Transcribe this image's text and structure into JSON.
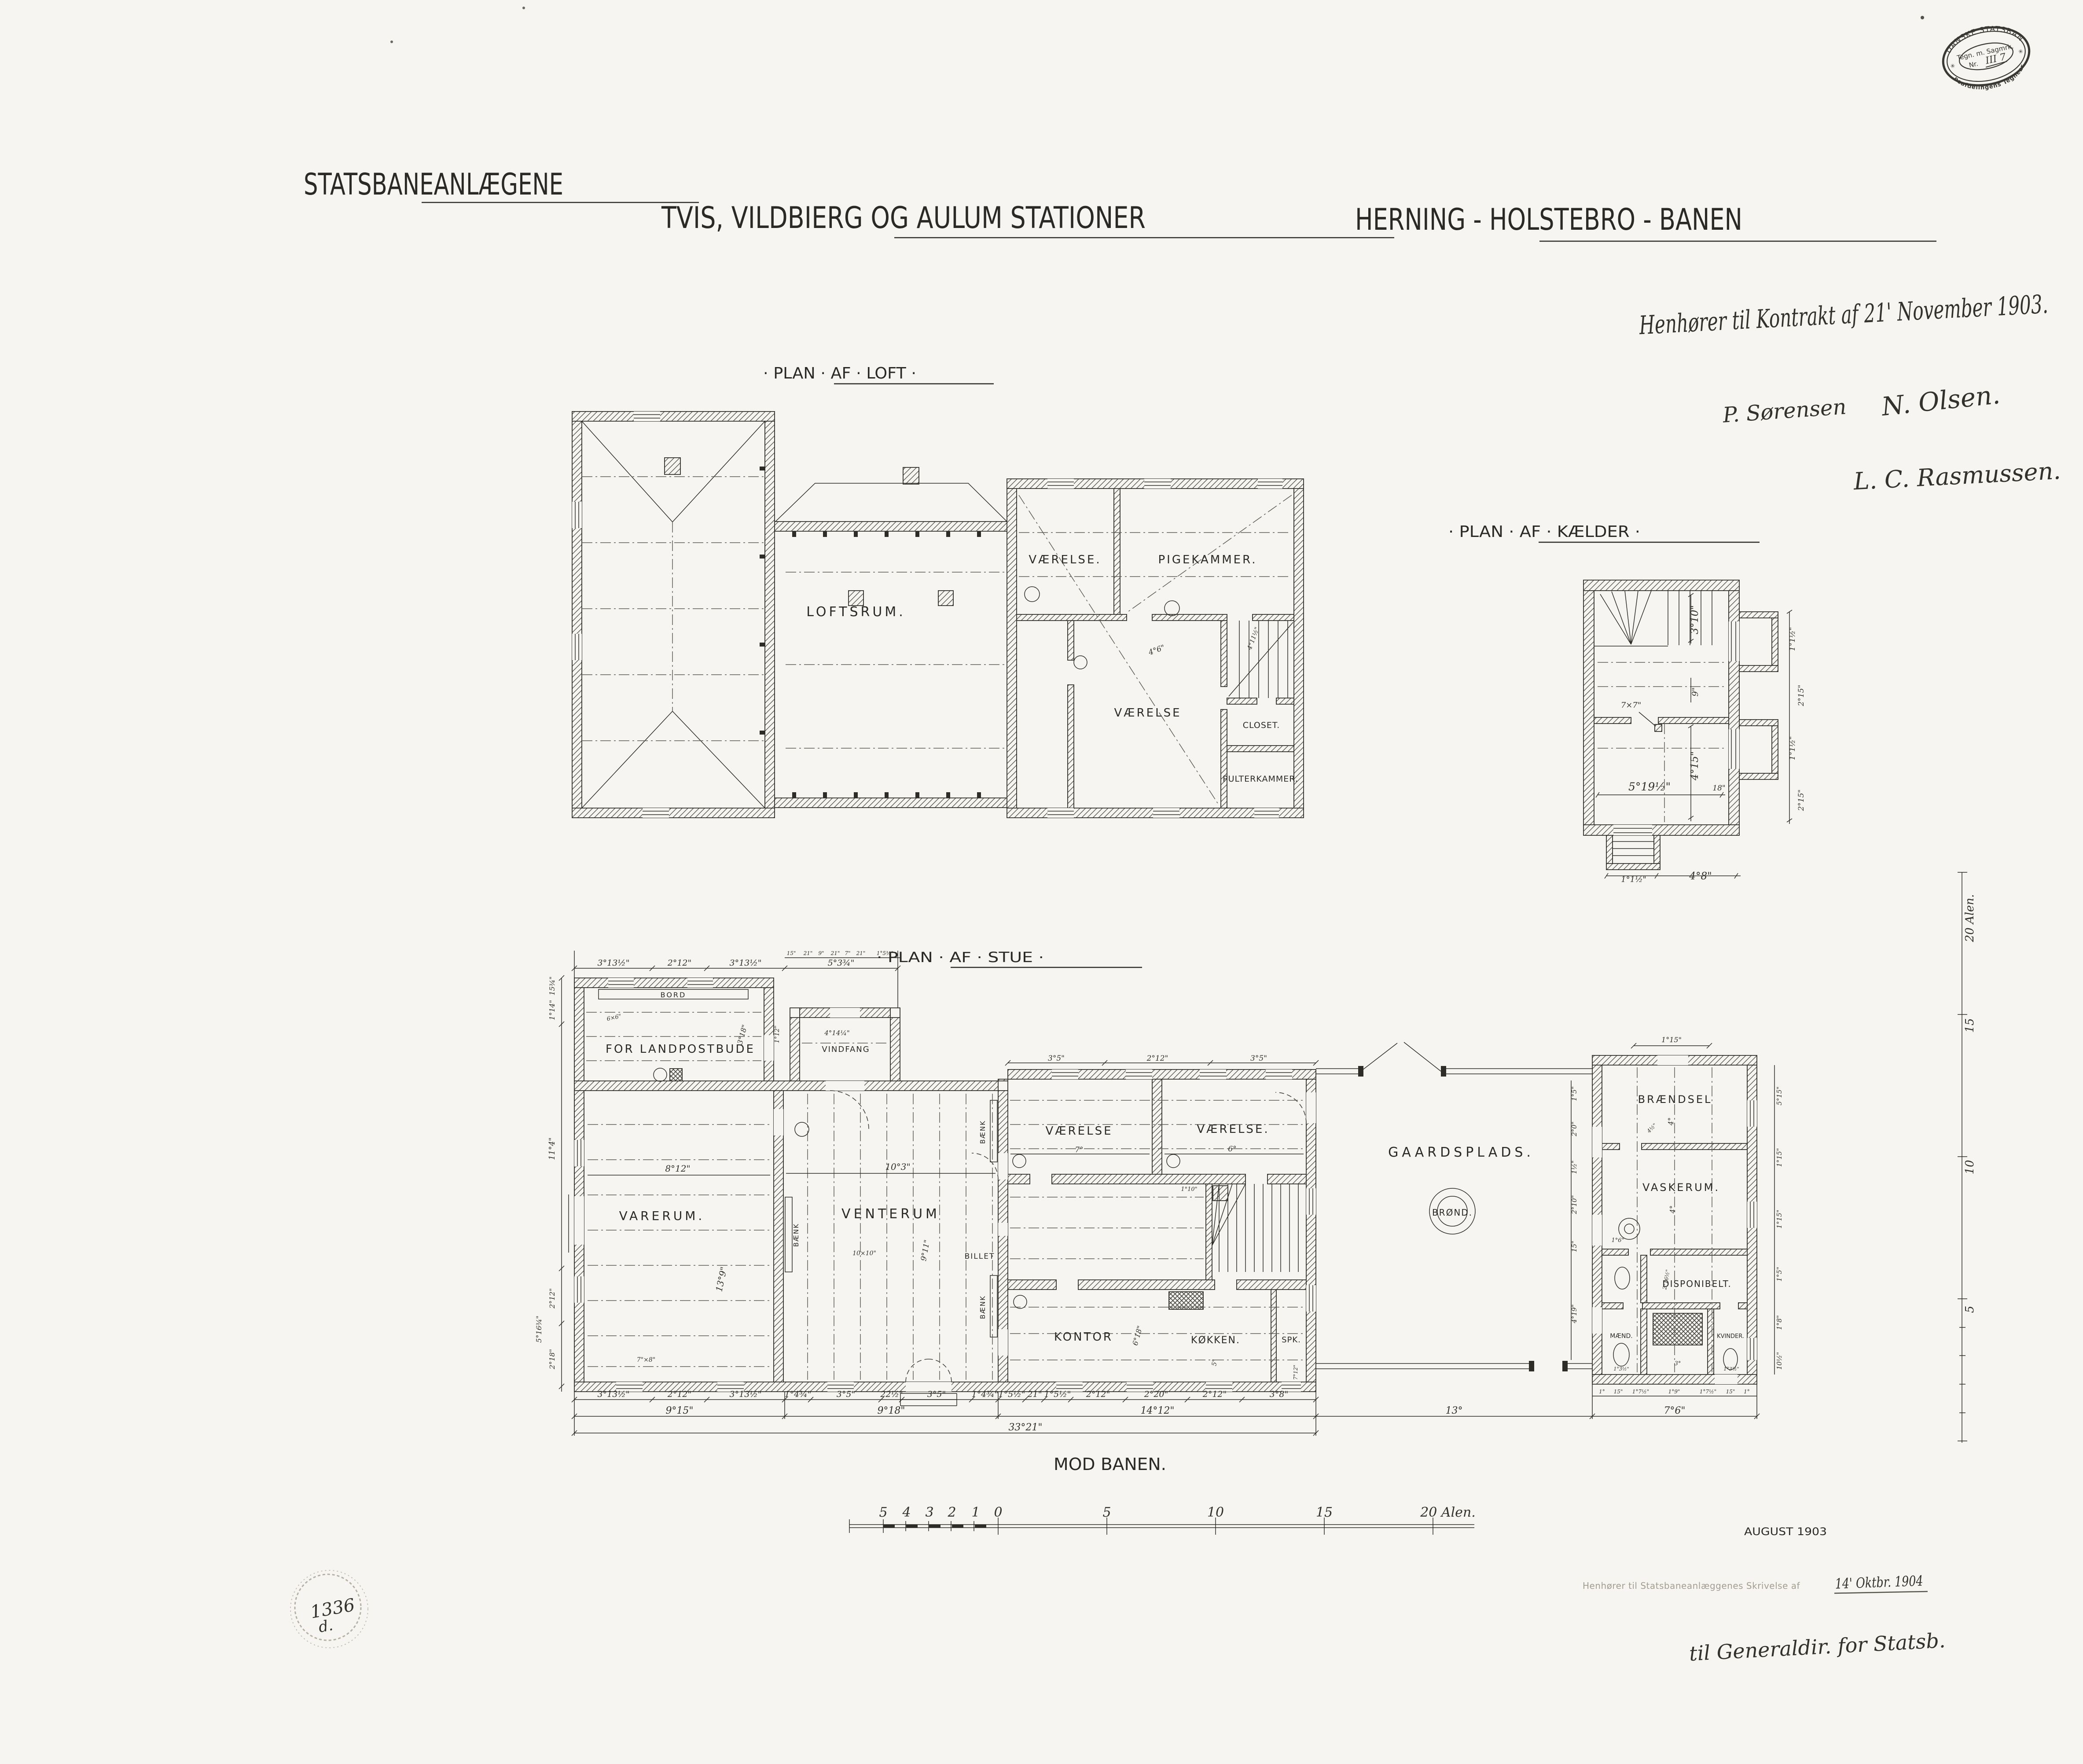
{
  "colors": {
    "paper": "#f6f5f1",
    "ink": "#2e2c27",
    "faint_ink": "#a39d8f",
    "stamp_ink": "#3a3832"
  },
  "header": {
    "program": "STATSBANEANLÆGENE",
    "title": "TVIS, VILDBIERG OG AULUM STATIONER",
    "railway": "HERNING - HOLSTEBRO - BANEN",
    "note": "Henhører til Kontrakt af 21' November 1903.",
    "signature_1": "P. Sørensen",
    "signature_2": "N. Olsen.",
    "signature_3": "L. C. Rasmussen."
  },
  "archive_stamp": {
    "arc_top": "DE DANSKE STATSBANER",
    "row": "Tegn. m. Sagmrk.",
    "nr_label": "Nr.",
    "nr_value": "III 7",
    "arc_bottom": "Baneafdelingens Tegnearkiv",
    "star": "✳"
  },
  "loft": {
    "title": "· PLAN · AF · LOFT ·",
    "rooms": {
      "loftsrum": "LOFTSRUM.",
      "vaerelse_nv": "VÆRELSE.",
      "pigekammer": "PIGEKAMMER.",
      "vaerelse_mid": "VÆRELSE",
      "closet": "CLOSET.",
      "pulterkammer": "PULTERKAMMER."
    },
    "dims": {
      "d1": "4°6\"",
      "d2": "4°11½\""
    }
  },
  "kaelder": {
    "title": "· PLAN · AF · KÆLDER ·",
    "dims": {
      "stair_h": "3°10\"",
      "gap9": "9\"",
      "post": "7×7\"",
      "room_h": "4°15\"",
      "room_w": "5°19½\"",
      "w18": "18\"",
      "right_1": "1°1½\"",
      "right_2": "2°15\"",
      "right_3": "1°1½\"",
      "right_4": "2°15\"",
      "bottom_1": "1°1½\"",
      "bottom_2": "4°8\""
    }
  },
  "stue": {
    "title": "· PLAN · AF · STUE ·",
    "rooms": {
      "landpost": "FOR LANDPOSTBUDE",
      "vindfang": "VINDFANG",
      "varerum": "VARERUM.",
      "venterum": "VENTERUM",
      "vaerelse_1": "VÆRELSE",
      "vaerelse_2": "VÆRELSE.",
      "kontor": "KONTOR",
      "koekken": "KØKKEN.",
      "spisekammer": "SPK.",
      "gaardsplads": "GAARDSPLADS.",
      "broend": "BRØND.",
      "braendsel": "BRÆNDSEL",
      "vaskerum": "VASKERUM.",
      "disponibelt": "DISPONIBELT.",
      "maend": "MÆND.",
      "kvinder": "KVINDER."
    },
    "furniture": {
      "bord": "BORD",
      "baenk": "BÆNK",
      "billet": "BILLET"
    },
    "dims": {
      "top_row": [
        "3°13½\"",
        "2°12\"",
        "3°13½\"",
        "5°3¾\""
      ],
      "top_small": [
        "15\"",
        "21\"",
        "9\"",
        "21\"",
        "7\"",
        "21\"",
        "1°5¾\""
      ],
      "wing_top": [
        "3°5\"",
        "2°12\"",
        "3°5\""
      ],
      "left_col": [
        "15¾\"",
        "1°14\"",
        "11°4\"",
        "2°12\"",
        "2°18\"",
        "5°16¾\""
      ],
      "row1": [
        "3°13½\"",
        "2°12\"",
        "3°13½\"",
        "1°4¾\"",
        "3°5\"",
        "22½\"",
        "3°5\"",
        "1°4¾\"",
        "1°5½\"",
        "21\"",
        "1°5½\"",
        "2°12\"",
        "2°20\"",
        "2°12\"",
        "3°8\""
      ],
      "row2": [
        "9°15\"",
        "9°18\"",
        "14°12\"",
        "13°",
        "7°6\""
      ],
      "row3": [
        "33°21\""
      ],
      "out_chain": [
        "1°",
        "15\"",
        "1°7½\"",
        "1°9\"",
        "1°7½\"",
        "15\"",
        "1°"
      ],
      "court_left": [
        "1°5\"",
        "2°0\"",
        "1½\"",
        "2°10\"",
        "15\"",
        "4°19\""
      ],
      "out_right": [
        "5°15\"",
        "1°15\"",
        "1°15\"",
        "1°5\"",
        "1°8\"",
        "10½\""
      ],
      "inner": {
        "varerum_w": "8°12\"",
        "varerum_h": "13°9\"",
        "varerum_note": "7\"×8\"",
        "venterum_w": "10°3\"",
        "venterum_note": "10×10\"",
        "venterum_h": "9°11\"",
        "bord_note": "6×6\"",
        "annex_h": "3°18\"",
        "annex_w": "1°12\"",
        "vindfang_w": "4°14¼\"",
        "v1": "7°",
        "v2": "6°",
        "kontor_d": "6°18\"",
        "koekken_d": "5°",
        "spk_d": "7°12\"",
        "stair_d": "1°10\"",
        "court_door": "1°15\"",
        "braendsel_h": "4°",
        "braendsel_n": "4½\"",
        "vask_h": "4°",
        "kedel": "1°6\"",
        "disp_d": "2°16½\"",
        "pit_d": "3°",
        "maend_d": "1°3½\"",
        "kvinder_d": "1°3½\""
      }
    }
  },
  "footer": {
    "mod_banen": "MOD BANEN.",
    "date": "AUGUST 1903",
    "approval_prefix": "Henhører til Statsbaneanlæggenes Skrivelse af",
    "approval_date": "14' Oktbr. 1904",
    "approval_note": "til Generaldir. for Statsb.",
    "archive_no": "1336",
    "archive_sub": "d."
  },
  "scalebar": {
    "minor": [
      "5",
      "4",
      "3",
      "2",
      "1",
      "0"
    ],
    "major": [
      "5",
      "10",
      "15"
    ],
    "end": "20 Alen."
  },
  "vruler": {
    "l20": "20 Alen.",
    "l15": "15",
    "l10": "10",
    "l5": "5"
  }
}
